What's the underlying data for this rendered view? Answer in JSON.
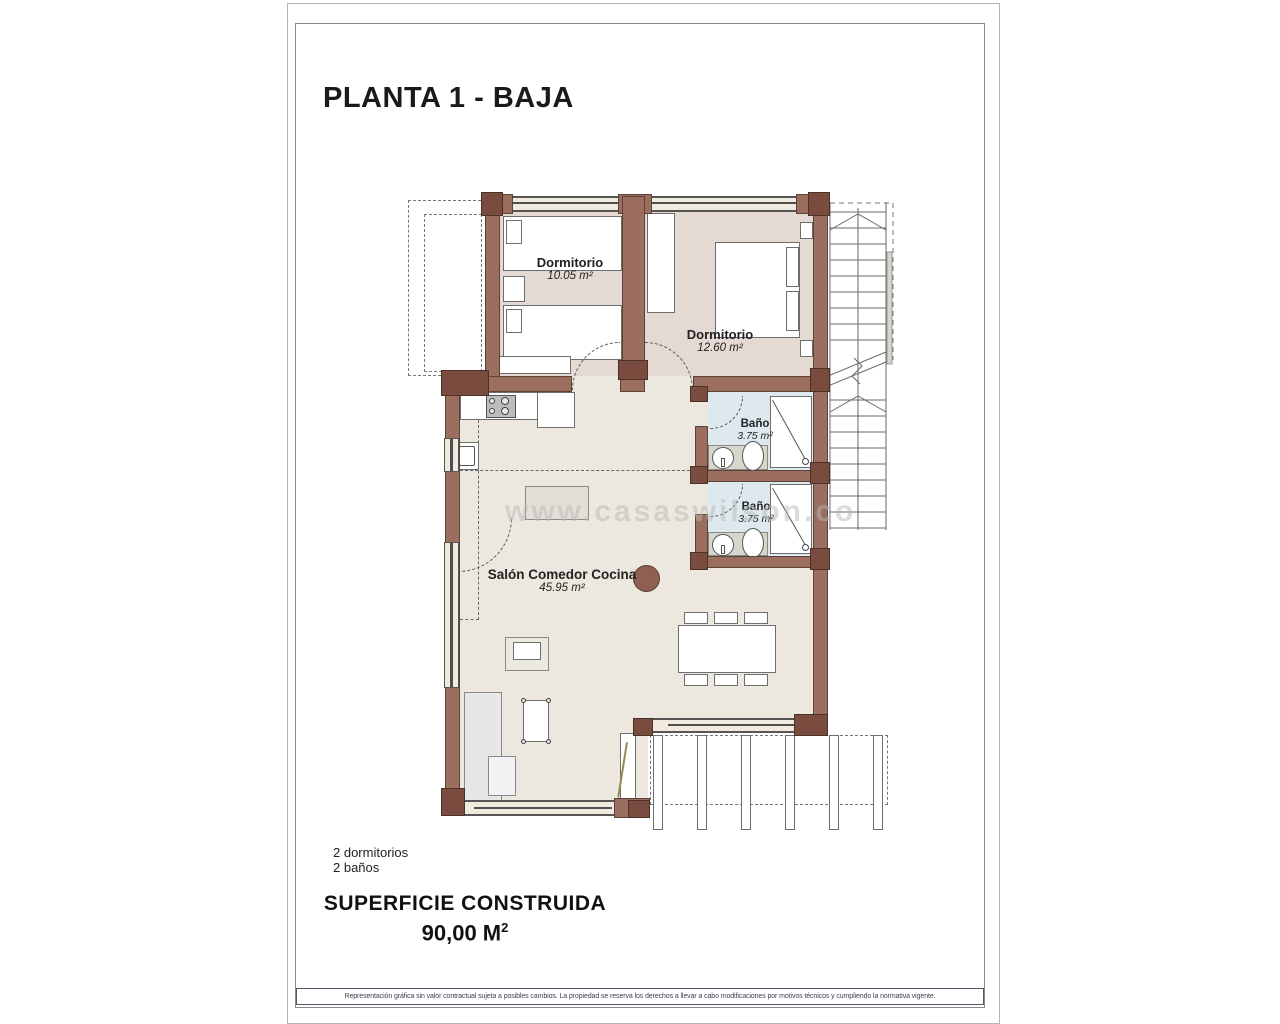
{
  "page": {
    "title": "PLANTA 1 - BAJA",
    "watermark": "www.casaswilson.co",
    "summary": {
      "line1": "2 dormitorios",
      "line2": "2 baños"
    },
    "built_area": {
      "label": "SUPERFICIE CONSTRUIDA",
      "value": "90,00 M",
      "superscript": "2"
    },
    "footer_disclaimer": "Representación gráfica sin valor contractual sujeta a posibles cambios. La propiedad se reserva los derechos a llevar a cabo modificaciones por motivos técnicos y cumpliendo la normativa vigente."
  },
  "rooms": [
    {
      "id": "bedroom-1",
      "label": "Dormitorio",
      "area": "10.05 m²"
    },
    {
      "id": "bedroom-2",
      "label": "Dormitorio",
      "area": "12.60 m²"
    },
    {
      "id": "bath-1",
      "label": "Baño",
      "area": "3.75 m²"
    },
    {
      "id": "bath-2",
      "label": "Baño",
      "area": "3.75 m²"
    },
    {
      "id": "living",
      "label": "Salón Comedor Cocina",
      "area": "45.95 m²"
    }
  ],
  "colors": {
    "wall": "#9c6e60",
    "wall_dark": "#7a4c3f",
    "floor_bedroom": "#e4dad3",
    "floor_living": "#ece8df",
    "floor_bath": "#dde9ee",
    "band": "#f0eadf",
    "line": "#4f4f4f",
    "watermark": "#b9b9b9",
    "footer_text": "#3c3c52"
  }
}
